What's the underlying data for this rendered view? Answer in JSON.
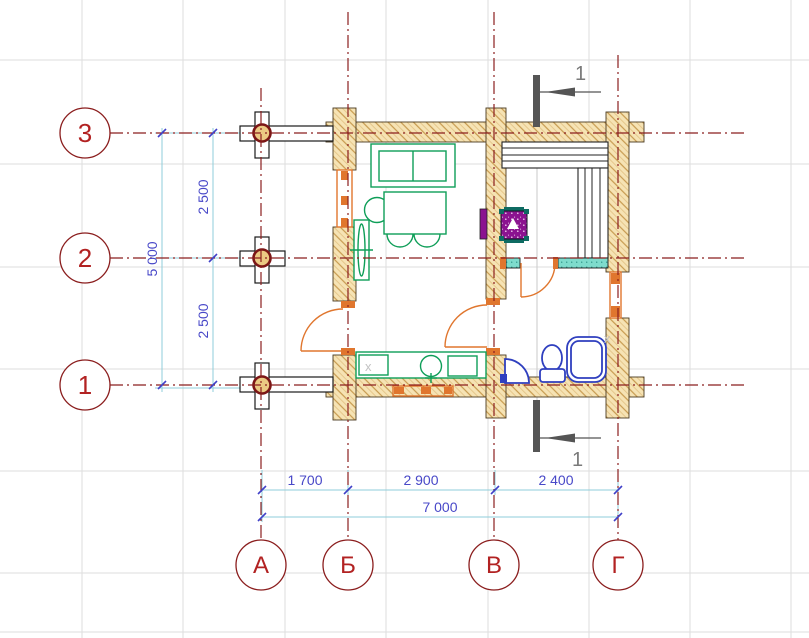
{
  "drawing": {
    "type": "log-house floor plan",
    "axes_horizontal": [
      {
        "label": "3"
      },
      {
        "label": "2"
      },
      {
        "label": "1"
      }
    ],
    "axes_vertical": [
      {
        "label": "А"
      },
      {
        "label": "Б"
      },
      {
        "label": "В"
      },
      {
        "label": "Г"
      }
    ],
    "dims": {
      "bottom": [
        "1 700",
        "2 900",
        "2 400"
      ],
      "bottom_total": "7 000",
      "left": [
        "2 500",
        "2 500"
      ],
      "left_total": "5 000"
    },
    "section": {
      "top": "1",
      "bottom": "1"
    },
    "markers": {
      "kitchen_block": "x",
      "window_block": "x"
    },
    "colors": {
      "axis_red": "#8B1E1E",
      "bubble_red": "#B22222",
      "dim_line": "#8FCEDB",
      "dim_text": "#4848C8",
      "wall_fill": "#F6E3B4",
      "wall_hatch": "#C79A4F",
      "furniture_green": "#0E9E58",
      "fixture_blue": "#2F3FBF",
      "door_window_orange": "#E0762E",
      "partition_teal": "#7EDCCD",
      "stove_purple": "#8B1390",
      "section_gray": "#555555",
      "grid_gray": "#DDDDDD"
    }
  }
}
